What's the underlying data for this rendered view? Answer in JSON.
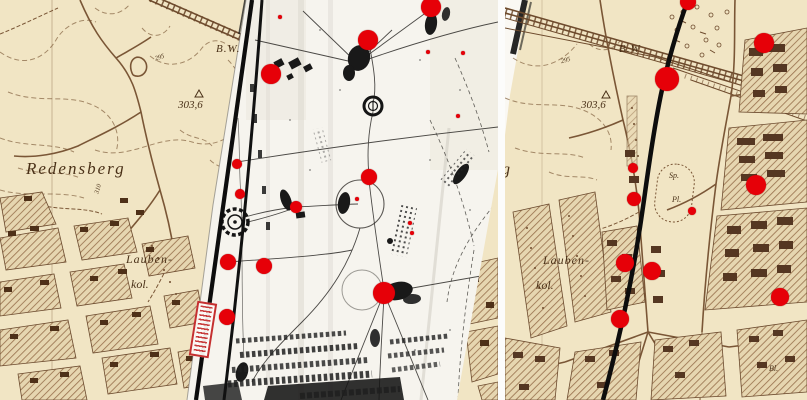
{
  "colors": {
    "map_bg": "#f1e5c4",
    "map_ink": "#6e4b2d",
    "marker_red": "#e60008",
    "photo_bg": "#f6f4ee",
    "photo_ink": "#191919",
    "stamp_red": "#c53030",
    "boundary_black": "#0d0d0d"
  },
  "panels": {
    "left": {
      "labels": {
        "redensberg": "Redensberg",
        "bw": "B.W.",
        "elevation": "303,6",
        "contour_a": "295",
        "contour_b": "310",
        "lauben": "Lauben-",
        "kol": "kol."
      },
      "markers": [
        {
          "x": 431,
          "y": 7,
          "r": 10
        },
        {
          "x": 368,
          "y": 40,
          "r": 10
        },
        {
          "x": 271,
          "y": 74,
          "r": 10
        },
        {
          "x": 237,
          "y": 164,
          "r": 5
        },
        {
          "x": 240,
          "y": 194,
          "r": 5
        },
        {
          "x": 369,
          "y": 177,
          "r": 8
        },
        {
          "x": 296,
          "y": 207,
          "r": 6
        },
        {
          "x": 264,
          "y": 266,
          "r": 8
        },
        {
          "x": 228,
          "y": 262,
          "r": 8
        },
        {
          "x": 227,
          "y": 317,
          "r": 8
        },
        {
          "x": 384,
          "y": 293,
          "r": 11
        },
        {
          "x": 280,
          "y": 17,
          "r": 2
        },
        {
          "x": 428,
          "y": 52,
          "r": 2
        },
        {
          "x": 463,
          "y": 53,
          "r": 2
        },
        {
          "x": 458,
          "y": 116,
          "r": 2
        },
        {
          "x": 357,
          "y": 199,
          "r": 2
        },
        {
          "x": 410,
          "y": 223,
          "r": 2
        },
        {
          "x": 412,
          "y": 233,
          "r": 2
        }
      ]
    },
    "right": {
      "labels": {
        "bw": "B.W.",
        "elevation": "303,6",
        "contour_a": "295",
        "berg_fragment": "g",
        "lauben": "Lauben-",
        "kol": "kol.",
        "sp": "Sp.",
        "pl": "Pl.",
        "bl": "Bl."
      },
      "markers": [
        {
          "x": 688,
          "y": 2,
          "r": 8
        },
        {
          "x": 764,
          "y": 43,
          "r": 10
        },
        {
          "x": 667,
          "y": 79,
          "r": 12
        },
        {
          "x": 633,
          "y": 168,
          "r": 5
        },
        {
          "x": 634,
          "y": 199,
          "r": 7
        },
        {
          "x": 756,
          "y": 185,
          "r": 10
        },
        {
          "x": 692,
          "y": 211,
          "r": 4
        },
        {
          "x": 625,
          "y": 263,
          "r": 9
        },
        {
          "x": 652,
          "y": 271,
          "r": 9
        },
        {
          "x": 780,
          "y": 297,
          "r": 9
        },
        {
          "x": 620,
          "y": 319,
          "r": 9
        }
      ]
    }
  }
}
